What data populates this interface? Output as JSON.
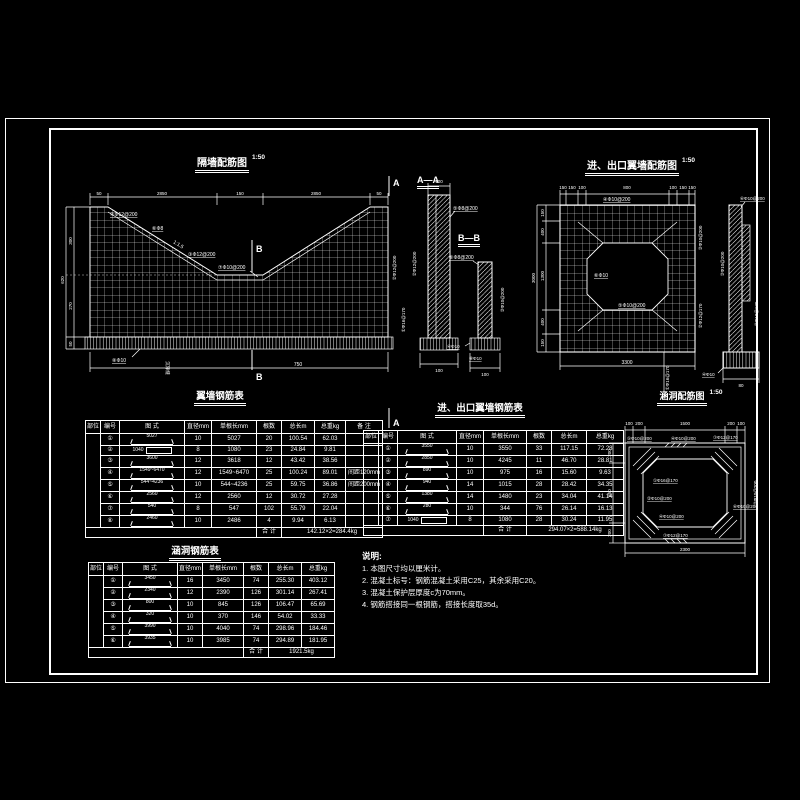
{
  "wall": {
    "title": "隔墙配筋图",
    "scale": "1:50",
    "dims_top": [
      "50",
      "2850",
      "150",
      "2850",
      "50"
    ],
    "dims_left": [
      "300",
      "270",
      "50"
    ],
    "dim_total_left": "620",
    "dim_bottom": "750",
    "callout_top": "④Φ12@200",
    "callout_mid": "⑥Φ8",
    "slope": "1:1.5",
    "callout_low": "③Φ12@200",
    "callout_v": "⑦Φ10@200",
    "callout_found": "⑧Φ10",
    "label_right_outer": "②Φ12@200",
    "label_right_inner": "①Φ16@170",
    "joint_label": "沉降缝",
    "marker_a": "A",
    "marker_b": "B"
  },
  "section_aa": {
    "title": "A—A",
    "dim_top": "100",
    "callout": "⑤Φ8@200",
    "label_left": "②Φ12@200",
    "dim_bottom": "100"
  },
  "section_bb": {
    "title": "B—B",
    "callout": "⑥Φ8@200",
    "label_right": "③Φ10@200",
    "callout_found": "④Φ10",
    "callout_found2": "⑧Φ10",
    "dim_bottom": "100"
  },
  "headwall": {
    "title": "进、出口翼墙配筋图",
    "scale": "1:50",
    "dims_top": [
      "150",
      "150",
      "100",
      "800",
      "100",
      "150",
      "150"
    ],
    "dims_left": [
      "150",
      "400",
      "1300",
      "400",
      "150"
    ],
    "dim_total_left": "3000",
    "dim_bottom": "3300",
    "callout_top": "④Φ10@200",
    "inside_a": "⑥Φ10",
    "inside_b": "⑤Φ10@200",
    "right_a": "③Φ10@200",
    "right_b": "②Φ12@170",
    "bottom_callout": "①Φ16@170",
    "side_top": "⑥Φ10@200",
    "side_left": "③Φ10@200",
    "side_right": "②Φ12@170",
    "side_bottom": "④Φ10",
    "side_dim": "80"
  },
  "culvert_plan": {
    "title": "涵洞配筋图",
    "scale": "1:50",
    "dims_top": [
      "100",
      "200",
      "1500",
      "200",
      "100"
    ],
    "dims_left": [
      "200",
      "850",
      "200"
    ],
    "dim_bottom": "2300",
    "c_tl": "⑤Φ10@200",
    "c_tm": "④Φ10@200",
    "c_tr": "⑦Φ12@170",
    "c_in1": "①Φ16@170",
    "c_in2": "②Φ10@200",
    "c_in3": "④Φ10@200",
    "c_bottom": "⑦Φ12@170",
    "c_right": "⑥Φ10@200",
    "c_rot": "③Φ10@200"
  },
  "tables": {
    "wing": {
      "title": "翼墙钢筋表",
      "headers": [
        "部位",
        "编号",
        "图  式",
        "直径mm",
        "单根长mm",
        "根数",
        "总长m",
        "总重kg",
        "备  注"
      ],
      "rows": [
        {
          "no": "①",
          "shape": "hook",
          "shape_label": "5027",
          "d": "10",
          "len": "5027",
          "n": "20",
          "L": "100.54",
          "W": "62.03",
          "note": ""
        },
        {
          "no": "②",
          "shape": "rect",
          "shape_label": "1040",
          "d": "8",
          "len": "1080",
          "n": "23",
          "L": "24.84",
          "W": "9.81",
          "note": ""
        },
        {
          "no": "③",
          "shape": "hook",
          "shape_label": "3600",
          "d": "12",
          "len": "3618",
          "n": "12",
          "L": "43.42",
          "W": "38.56",
          "note": ""
        },
        {
          "no": "④",
          "shape": "hook",
          "shape_label": "1549~6470",
          "d": "12",
          "len": "1549~6470",
          "n": "25",
          "L": "100.24",
          "W": "89.01",
          "note": "间距120mm"
        },
        {
          "no": "⑤",
          "shape": "hook",
          "shape_label": "544~4236",
          "d": "10",
          "len": "544~4236",
          "n": "25",
          "L": "59.75",
          "W": "36.86",
          "note": "间距200mm"
        },
        {
          "no": "⑥",
          "shape": "hook",
          "shape_label": "2560",
          "d": "12",
          "len": "2560",
          "n": "12",
          "L": "30.72",
          "W": "27.28",
          "note": ""
        },
        {
          "no": "⑦",
          "shape": "hook",
          "shape_label": "540",
          "d": "8",
          "len": "547",
          "n": "102",
          "L": "55.79",
          "W": "22.04",
          "note": ""
        },
        {
          "no": "⑧",
          "shape": "hook",
          "shape_label": "2460",
          "d": "10",
          "len": "2486",
          "n": "4",
          "L": "9.94",
          "W": "6.13",
          "note": ""
        }
      ],
      "total_label": "合  计",
      "total_value": "142.12×2=284.4kg"
    },
    "inout": {
      "title": "进、出口翼墙钢筋表",
      "headers": [
        "部位",
        "编号",
        "图  式",
        "直径mm",
        "单根长mm",
        "根数",
        "总长m",
        "总重kg"
      ],
      "rows": [
        {
          "no": "①",
          "shape": "hook",
          "shape_label": "3550",
          "d": "10",
          "len": "3550",
          "n": "33",
          "L": "117.15",
          "W": "72.28"
        },
        {
          "no": "②",
          "shape": "hook",
          "shape_label": "2850",
          "d": "10",
          "len": "4245",
          "n": "11",
          "L": "46.70",
          "W": "28.81"
        },
        {
          "no": "③",
          "shape": "hook",
          "shape_label": "890",
          "d": "10",
          "len": "975",
          "n": "16",
          "L": "15.60",
          "W": "9.63"
        },
        {
          "no": "④",
          "shape": "hook",
          "shape_label": "940",
          "d": "14",
          "len": "1015",
          "n": "28",
          "L": "28.42",
          "W": "34.35"
        },
        {
          "no": "⑤",
          "shape": "hook",
          "shape_label": "1380",
          "d": "14",
          "len": "1480",
          "n": "23",
          "L": "34.04",
          "W": "41.14"
        },
        {
          "no": "⑥",
          "shape": "hook",
          "shape_label": "280",
          "d": "10",
          "len": "344",
          "n": "76",
          "L": "26.14",
          "W": "16.13"
        },
        {
          "no": "⑦",
          "shape": "rect",
          "shape_label": "1040",
          "d": "8",
          "len": "1080",
          "n": "28",
          "L": "30.24",
          "W": "11.95"
        }
      ],
      "total_label": "合  计",
      "total_value": "294.07×2=588.14kg"
    },
    "culvert": {
      "title": "涵洞钢筋表",
      "headers": [
        "部位",
        "编号",
        "图  式",
        "直径mm",
        "单根长mm",
        "根数",
        "总长m",
        "总重kg"
      ],
      "rows": [
        {
          "no": "①",
          "shape": "hook",
          "shape_label": "3450",
          "d": "16",
          "len": "3450",
          "n": "74",
          "L": "255.30",
          "W": "403.12"
        },
        {
          "no": "②",
          "shape": "hook",
          "shape_label": "2340",
          "d": "12",
          "len": "2390",
          "n": "126",
          "L": "301.14",
          "W": "267.41"
        },
        {
          "no": "③",
          "shape": "hook",
          "shape_label": "800",
          "d": "10",
          "len": "845",
          "n": "126",
          "L": "106.47",
          "W": "65.69"
        },
        {
          "no": "④",
          "shape": "hook",
          "shape_label": "320",
          "d": "10",
          "len": "370",
          "n": "146",
          "L": "54.02",
          "W": "33.33"
        },
        {
          "no": "⑤",
          "shape": "hook",
          "shape_label": "3990",
          "d": "10",
          "len": "4040",
          "n": "74",
          "L": "298.96",
          "W": "184.46"
        },
        {
          "no": "⑥",
          "shape": "hook",
          "shape_label": "3935",
          "d": "10",
          "len": "3985",
          "n": "74",
          "L": "294.89",
          "W": "181.95"
        }
      ],
      "total_label": "合  计",
      "total_value": "1921.5kg"
    }
  },
  "notes": {
    "title": "说明:",
    "lines": [
      "1. 本图尺寸均以厘米计。",
      "2. 混凝土标号：钢筋混凝土采用C25，其余采用C20。",
      "3. 混凝土保护层厚度c为70mm。",
      "4. 钢筋搭接同一根钢筋，搭接长度取35d。"
    ]
  }
}
